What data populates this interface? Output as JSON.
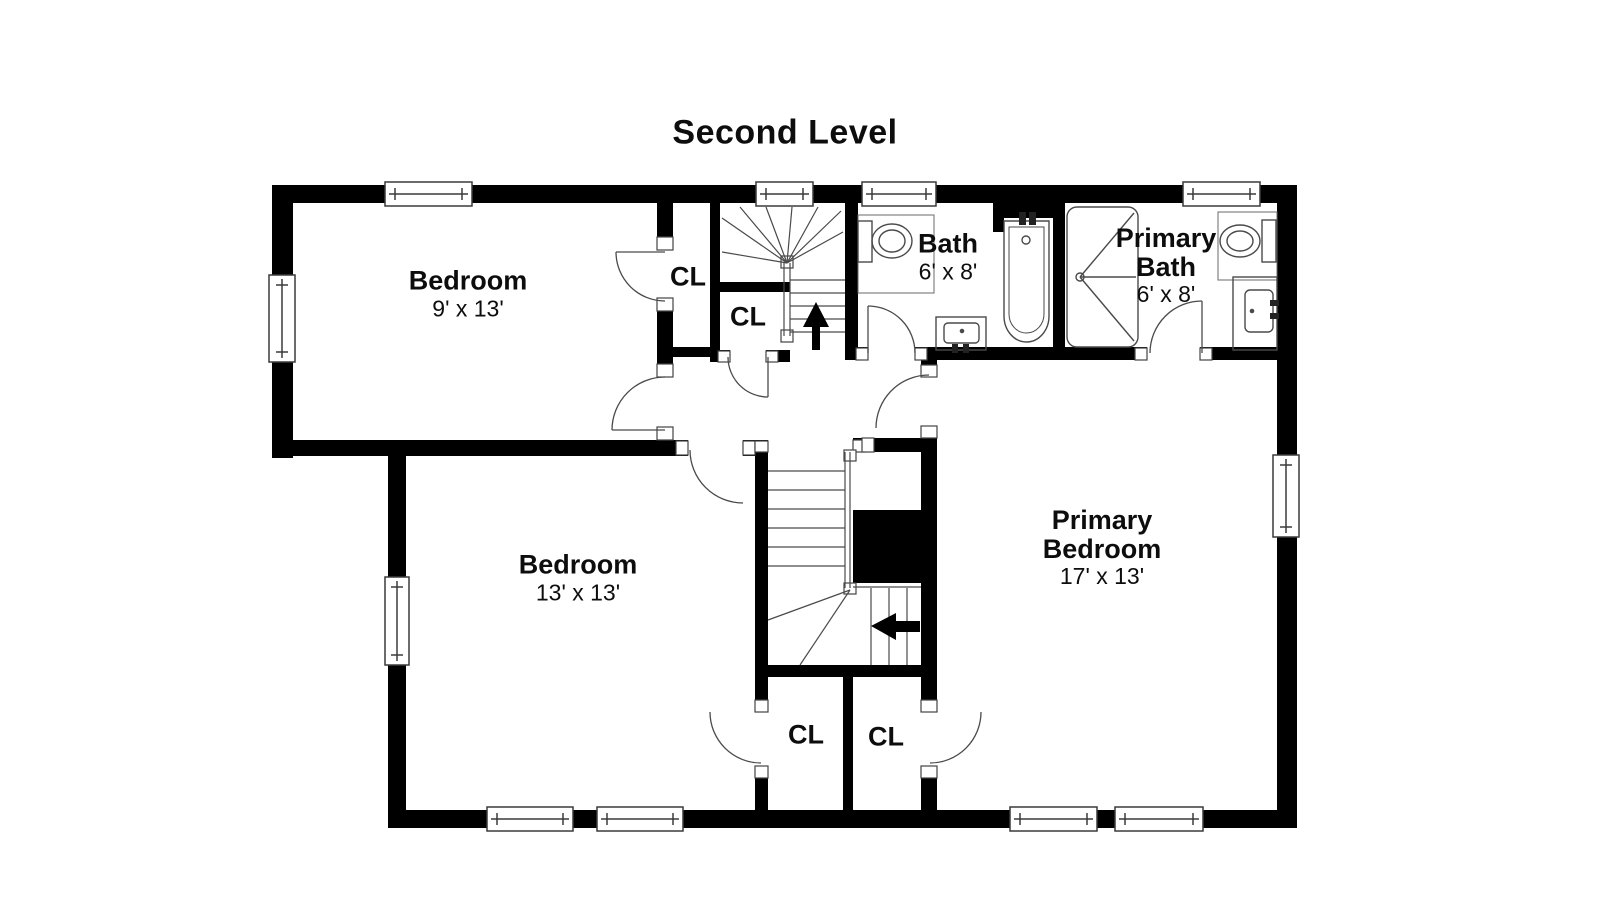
{
  "title": "Second Level",
  "rooms": {
    "bedroom_top_left": {
      "name": "Bedroom",
      "dims": "9' x 13'"
    },
    "bedroom_bottom_left": {
      "name": "Bedroom",
      "dims": "13' x 13'"
    },
    "primary_bedroom": {
      "name_line1": "Primary",
      "name_line2": "Bedroom",
      "dims": "17' x 13'"
    },
    "bath": {
      "name": "Bath",
      "dims": "6' x 8'"
    },
    "primary_bath": {
      "name_line1": "Primary",
      "name_line2": "Bath",
      "dims": "6' x 8'"
    }
  },
  "closets": {
    "upper_left": "CL",
    "upper_middle": "CL",
    "lower_left": "CL",
    "lower_right": "CL"
  },
  "stairs": {
    "up_arrow_icon": "arrow-up",
    "down_arrow_icon": "arrow-left"
  },
  "fixtures": {
    "bath": [
      "toilet",
      "sink-vanity",
      "bathtub"
    ],
    "primary_bath": [
      "shower",
      "toilet",
      "sink-vanity"
    ]
  },
  "colors": {
    "walls": "#000000",
    "background": "#ffffff",
    "symbol_lines": "#444444",
    "text": "#0d0d0d"
  }
}
